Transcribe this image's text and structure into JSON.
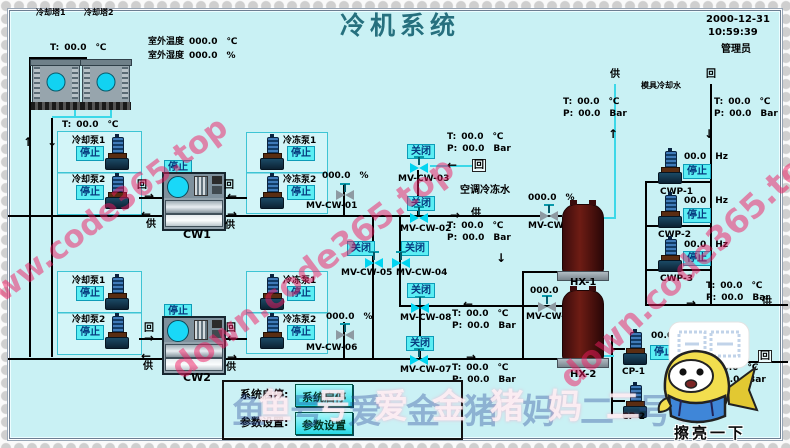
{
  "header": {
    "title": "冷机系统",
    "date": "2000-12-31",
    "time": "10:59:39",
    "user": "管理员"
  },
  "env": {
    "temp_label": "室外温度",
    "temp_value": "000.0",
    "temp_unit": "℃",
    "hum_label": "室外湿度",
    "hum_value": "000.0",
    "hum_unit": "%"
  },
  "towers": {
    "t1": "冷却塔1",
    "t2": "冷却塔2"
  },
  "tp": {
    "tl": "T:",
    "tv": "00.0",
    "tu": "℃",
    "pl": "P:",
    "pv": "00.0",
    "pu": "Bar"
  },
  "t_only": {
    "l": "T:",
    "v": "00.0",
    "u": "℃"
  },
  "labels": {
    "supply": "供",
    "ret": "回",
    "ac_water": "空调冷冻水",
    "mold_water": "模具冷却水"
  },
  "chillers": {
    "cw1": {
      "name": "CW1",
      "status": "停止"
    },
    "cw2": {
      "name": "CW2",
      "status": "停止"
    }
  },
  "pumps": {
    "cool1a": {
      "name": "冷却泵1",
      "status": "停止"
    },
    "cool1b": {
      "name": "冷却泵2",
      "status": "停止"
    },
    "chill1a": {
      "name": "冷冻泵1",
      "status": "停止"
    },
    "chill1b": {
      "name": "冷冻泵2",
      "status": "停止"
    },
    "cool2a": {
      "name": "冷却泵1",
      "status": "停止"
    },
    "cool2b": {
      "name": "冷却泵2",
      "status": "停止"
    },
    "chill2a": {
      "name": "冷冻泵1",
      "status": "停止"
    },
    "chill2b": {
      "name": "冷冻泵2",
      "status": "停止"
    },
    "cwp1": {
      "name": "CWP-1",
      "hz": "00.0",
      "hz_unit": "Hz",
      "status": "停止"
    },
    "cwp2": {
      "name": "CWP-2",
      "hz": "00.0",
      "hz_unit": "Hz",
      "status": "停止"
    },
    "cwp3": {
      "name": "CWP-3",
      "hz": "00.0",
      "hz_unit": "Hz",
      "status": "停止"
    },
    "cp1": {
      "name": "CP-1",
      "hz": "00.0",
      "hz_unit": "Hz",
      "status": "停止"
    },
    "cp2": {
      "name": "CP-2"
    }
  },
  "valves": {
    "mv01": {
      "id": "MV-CW-01",
      "value": "000.0",
      "unit": "%"
    },
    "mv02": {
      "id": "MV-CW-02",
      "status": "关闭"
    },
    "mv03": {
      "id": "MV-CW-03",
      "status": "关闭"
    },
    "mv04": {
      "id": "MV-CW-04",
      "status": "关闭"
    },
    "mv05": {
      "id": "MV-CW-05",
      "status": "关闭"
    },
    "mv06": {
      "id": "MV-CW-06",
      "value": "000.0",
      "unit": "%"
    },
    "mv07": {
      "id": "MV-CW-07",
      "status": "关闭"
    },
    "mv08": {
      "id": "MV-CW-08",
      "status": "关闭"
    },
    "mv09": {
      "id": "MV-CW-09",
      "value": "000.0",
      "unit": "%"
    },
    "mv10": {
      "id": "MV-CW-10",
      "value": "000.0",
      "unit": ""
    }
  },
  "hx": {
    "hx1": "HX-1",
    "hx2": "HX-2"
  },
  "controls": {
    "start_label": "系统启停:",
    "start_btn": "系统启停",
    "param_label": "参数设置:",
    "param_btn": "参数设置"
  },
  "icons": {
    "up": "↑",
    "down": "↓",
    "left": "←",
    "right": "→"
  },
  "watermarks": {
    "red_left": "www.code365.top",
    "red_mid": "down.code365.top",
    "red_right": "down.code365.top",
    "bottom": "鱼号爱金猪妈二号",
    "mascot_caption": "擦亮一下"
  }
}
